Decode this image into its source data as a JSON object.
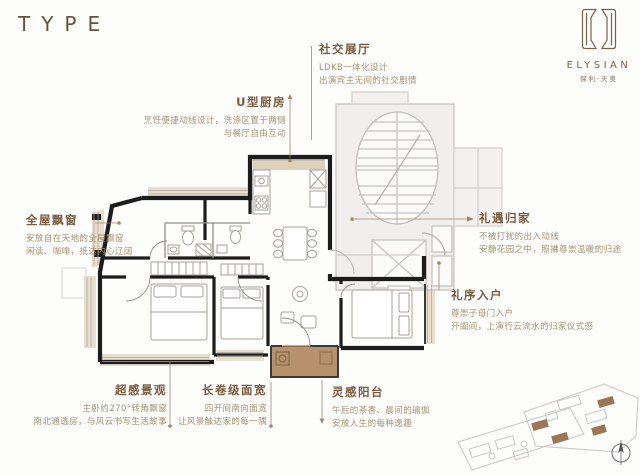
{
  "header": {
    "type_label": "TYPE"
  },
  "logo": {
    "brand": "ELYSIAN",
    "brand_cn": "保利·天奥",
    "emblem_icon": "elysian-monogram"
  },
  "callouts": {
    "social": {
      "title": "社交展厅",
      "line1": "LDKB一体化设计",
      "line2": "出演宾主无间的社交剧情"
    },
    "kitchen": {
      "title": "U型厨房",
      "line1": "烹饪便捷动线设计，洗涤区置于两侧",
      "line2": "与餐厅自由互动"
    },
    "bay_window": {
      "title": "全屋飘窗",
      "line1": "安放自在天地的全屋飘窗",
      "line2": "闲读、咖啡，抵达内心辽阔"
    },
    "homecoming": {
      "title": "礼遇归家",
      "line1": "不被打扰的出入动线",
      "line2": "安静花园之中，照拂尊崇温暖的归途"
    },
    "entry": {
      "title": "礼序入户",
      "line1": "尊崇子母门入户",
      "line2": "开阖间，上演行云流水的归家仪式感"
    },
    "view": {
      "title": "超感景观",
      "line1": "主卧约270°转角飘窗",
      "line2": "南北通透房，与风云书写生活故事"
    },
    "facade_width": {
      "title": "长卷级面宽",
      "line1": "四开间南向面宽",
      "line2": "让风景触达家的每一隅"
    },
    "balcony": {
      "title": "灵感阳台",
      "line1": "午后的茶香、晨间的瑜伽",
      "line2": "安放人生的每种逸趣"
    }
  },
  "colors": {
    "accent_brown": "#7b5b3e",
    "body_text": "#a8906f",
    "leader_line": "#a3866a",
    "wall_black": "#1c1c1c",
    "bay_beige": "#e7decd",
    "counter_tan": "#ddd1bc",
    "balcony_fill": "#b6916b",
    "core_gray": "#c6c4c0",
    "site_highlight": "#9d7553"
  }
}
